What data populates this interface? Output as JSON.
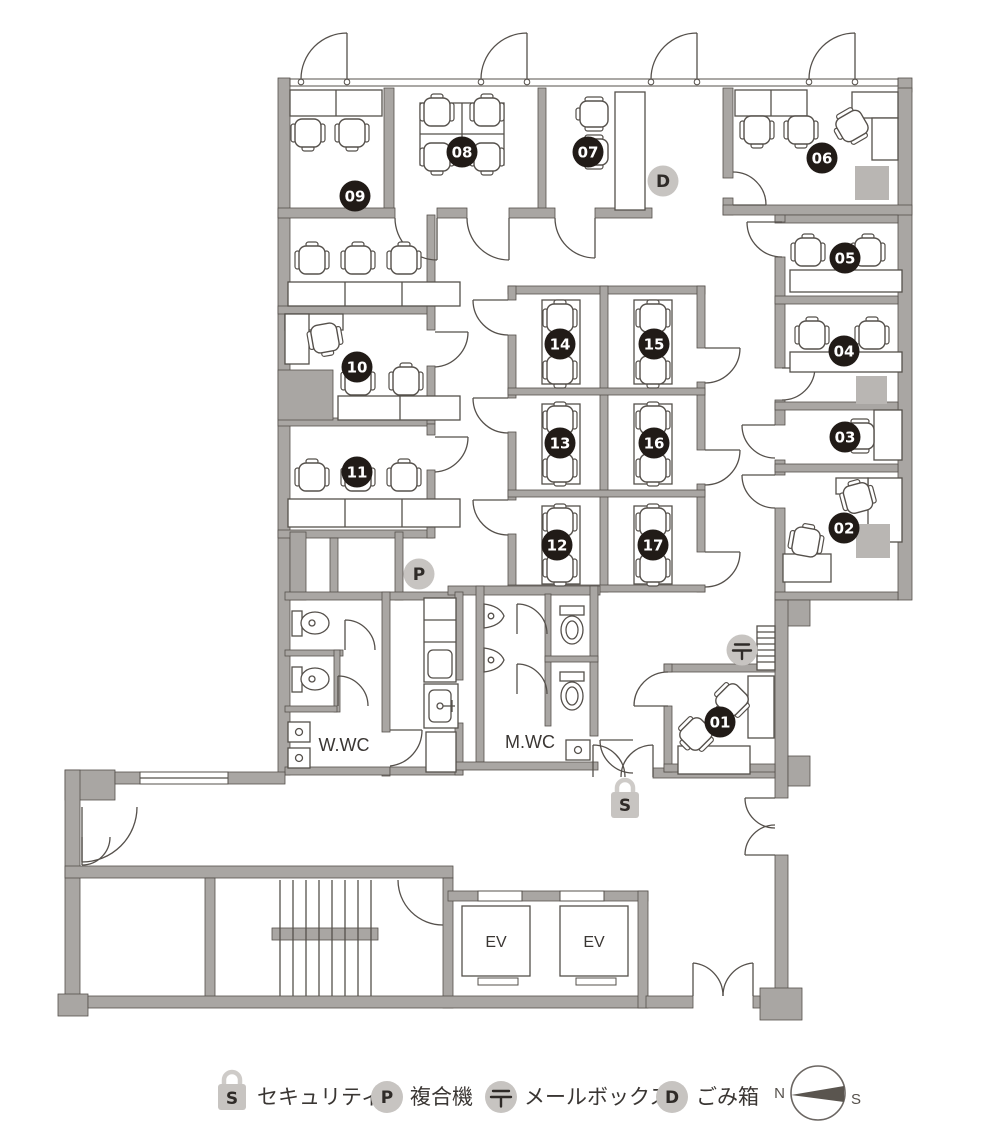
{
  "plan": {
    "rooms": [
      "01",
      "02",
      "03",
      "04",
      "05",
      "06",
      "07",
      "08",
      "09",
      "10",
      "11",
      "12",
      "13",
      "14",
      "15",
      "16",
      "17"
    ],
    "labels": {
      "womens_wc": "W.WC",
      "mens_wc": "M.WC",
      "elevator": "EV"
    },
    "facilities": {
      "security": {
        "symbol": "S",
        "label": "セキュリティ"
      },
      "printer": {
        "symbol": "P",
        "label": "複合機"
      },
      "mailbox": {
        "symbol": "〒",
        "label": "メールボックス"
      },
      "trash": {
        "symbol": "D",
        "label": "ごみ箱"
      }
    },
    "compass": {
      "north": "N",
      "south": "S"
    },
    "colors": {
      "wall": "#a9a6a3",
      "line": "#55504b",
      "badge": "#211b17",
      "facility_badge": "#c7c4c1"
    }
  }
}
